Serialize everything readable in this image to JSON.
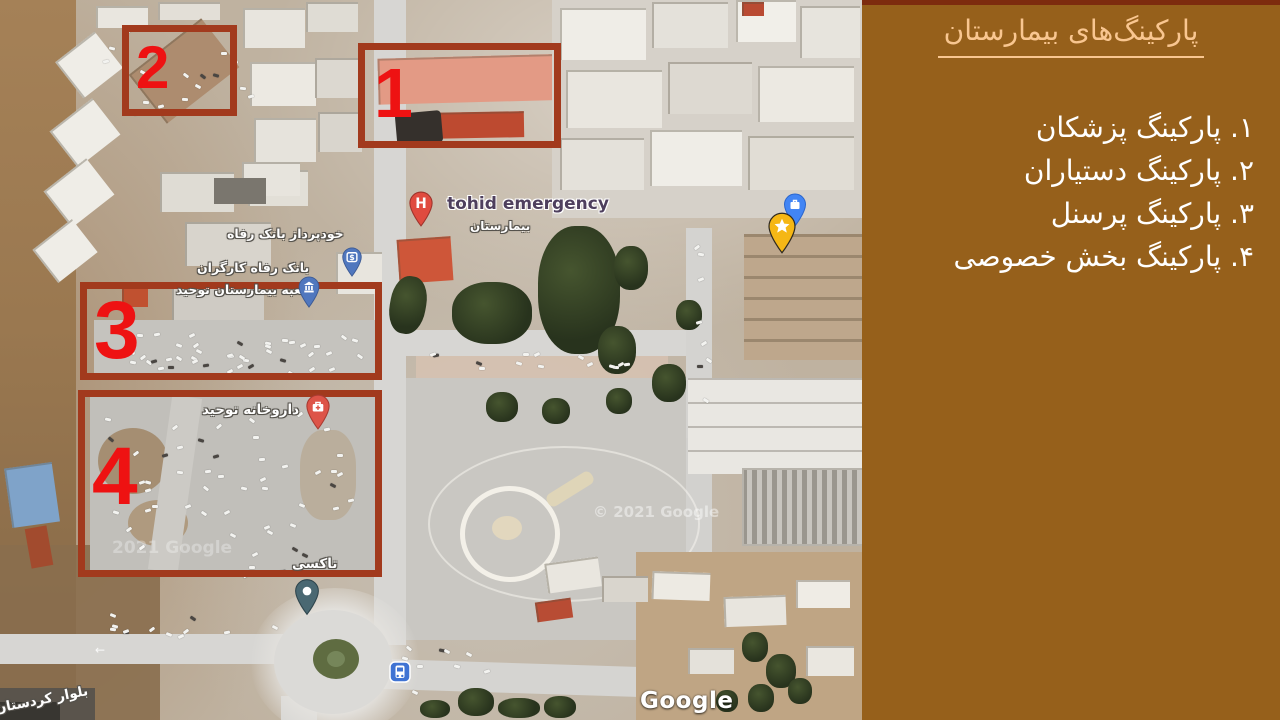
{
  "sidebar": {
    "title": "پارکینگ‌های بیمارستان",
    "items": [
      "۱. پارکینگ پزشکان",
      "۲. پارکینگ دستیاران",
      "۳. پارکینگ پرسنل",
      "۴. پارکینگ بخش خصوصی"
    ],
    "background_color": "#96601B",
    "title_color": "#F9C690",
    "text_color": "#FFFFFF",
    "top_strip_color": "#7D2B0E"
  },
  "annotations": {
    "box_border_color": "#A23A1D",
    "number_color": "#EE1212",
    "boxes": [
      {
        "number": "1"
      },
      {
        "number": "2"
      },
      {
        "number": "3"
      },
      {
        "number": "4"
      }
    ]
  },
  "map": {
    "labels": {
      "emergency": "tohid emergency",
      "hospital_fa": "بیمارستان",
      "atm": "خودپرداز بانک رفاه",
      "bank_line1": "بانک رفاه کارگران",
      "bank_line2": "شعبه بیمارستان توحید",
      "pharmacy": "داروخانه توحید",
      "taxi": "تاکسی",
      "boulevard": "بلوار کردستان",
      "google_logo": "Google",
      "copyright_center": "© 2021 Google",
      "copyright_left": "2021 Google"
    },
    "icons": {
      "hospital_pin": "H",
      "atm_pin": "$",
      "bank_pin": "bank-building",
      "pharmacy_pin": "first-aid-kit",
      "taxi_pin": "dot",
      "bus_stop": "bus",
      "briefcase_pin": "briefcase",
      "star_pin": "star"
    },
    "pin_colors": {
      "hospital": "#E04B3F",
      "pharmacy": "#DD5448",
      "bank_blue": "#5077BE",
      "briefcase_blue": "#4285F4",
      "star_yellow": "#F5B715",
      "taxi_teal": "#4A6872",
      "bus_blue": "#3F73D3"
    }
  }
}
